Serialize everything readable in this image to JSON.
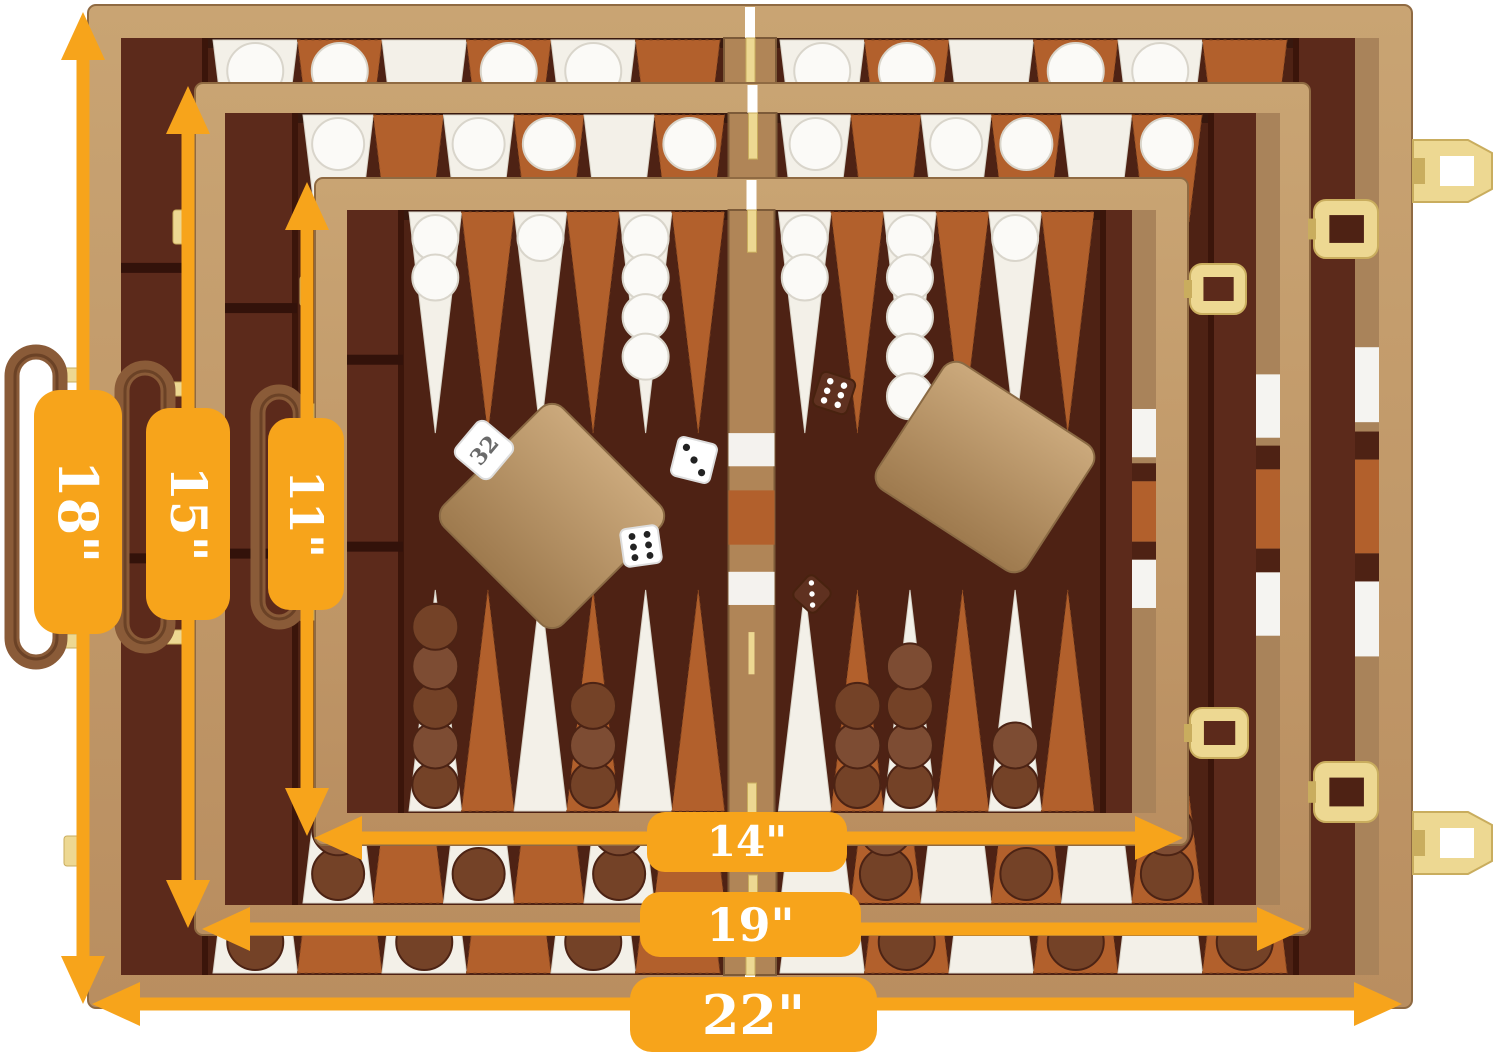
{
  "dimensions": {
    "case_large_height": "18\"",
    "case_medium_height": "15\"",
    "case_small_height": "11\"",
    "case_small_width": "14\"",
    "case_medium_width": "19\"",
    "case_large_width": "22\""
  },
  "product": {
    "doubling_cube": "32"
  },
  "colors": {
    "accent": "#F7A41B",
    "label_text": "#FFFFFF",
    "case_tan": "#B98E60",
    "case_tan_light": "#C9A473",
    "case_tan_dark": "#8F6A42",
    "felt": "#4E2214",
    "felt_dark": "#3B150A",
    "felt_light": "#5C2A1B",
    "point_white": "#F3F0E8",
    "point_sienna": "#B2602C",
    "checker_white": "#FBFAF7",
    "checker_brown": "#744227",
    "leather": "#8A5B38",
    "gold": "#EDD892",
    "gold_dark": "#C9AD5E",
    "hinge_tan": "#B08557",
    "cup_tan": "#BE9C6E"
  }
}
